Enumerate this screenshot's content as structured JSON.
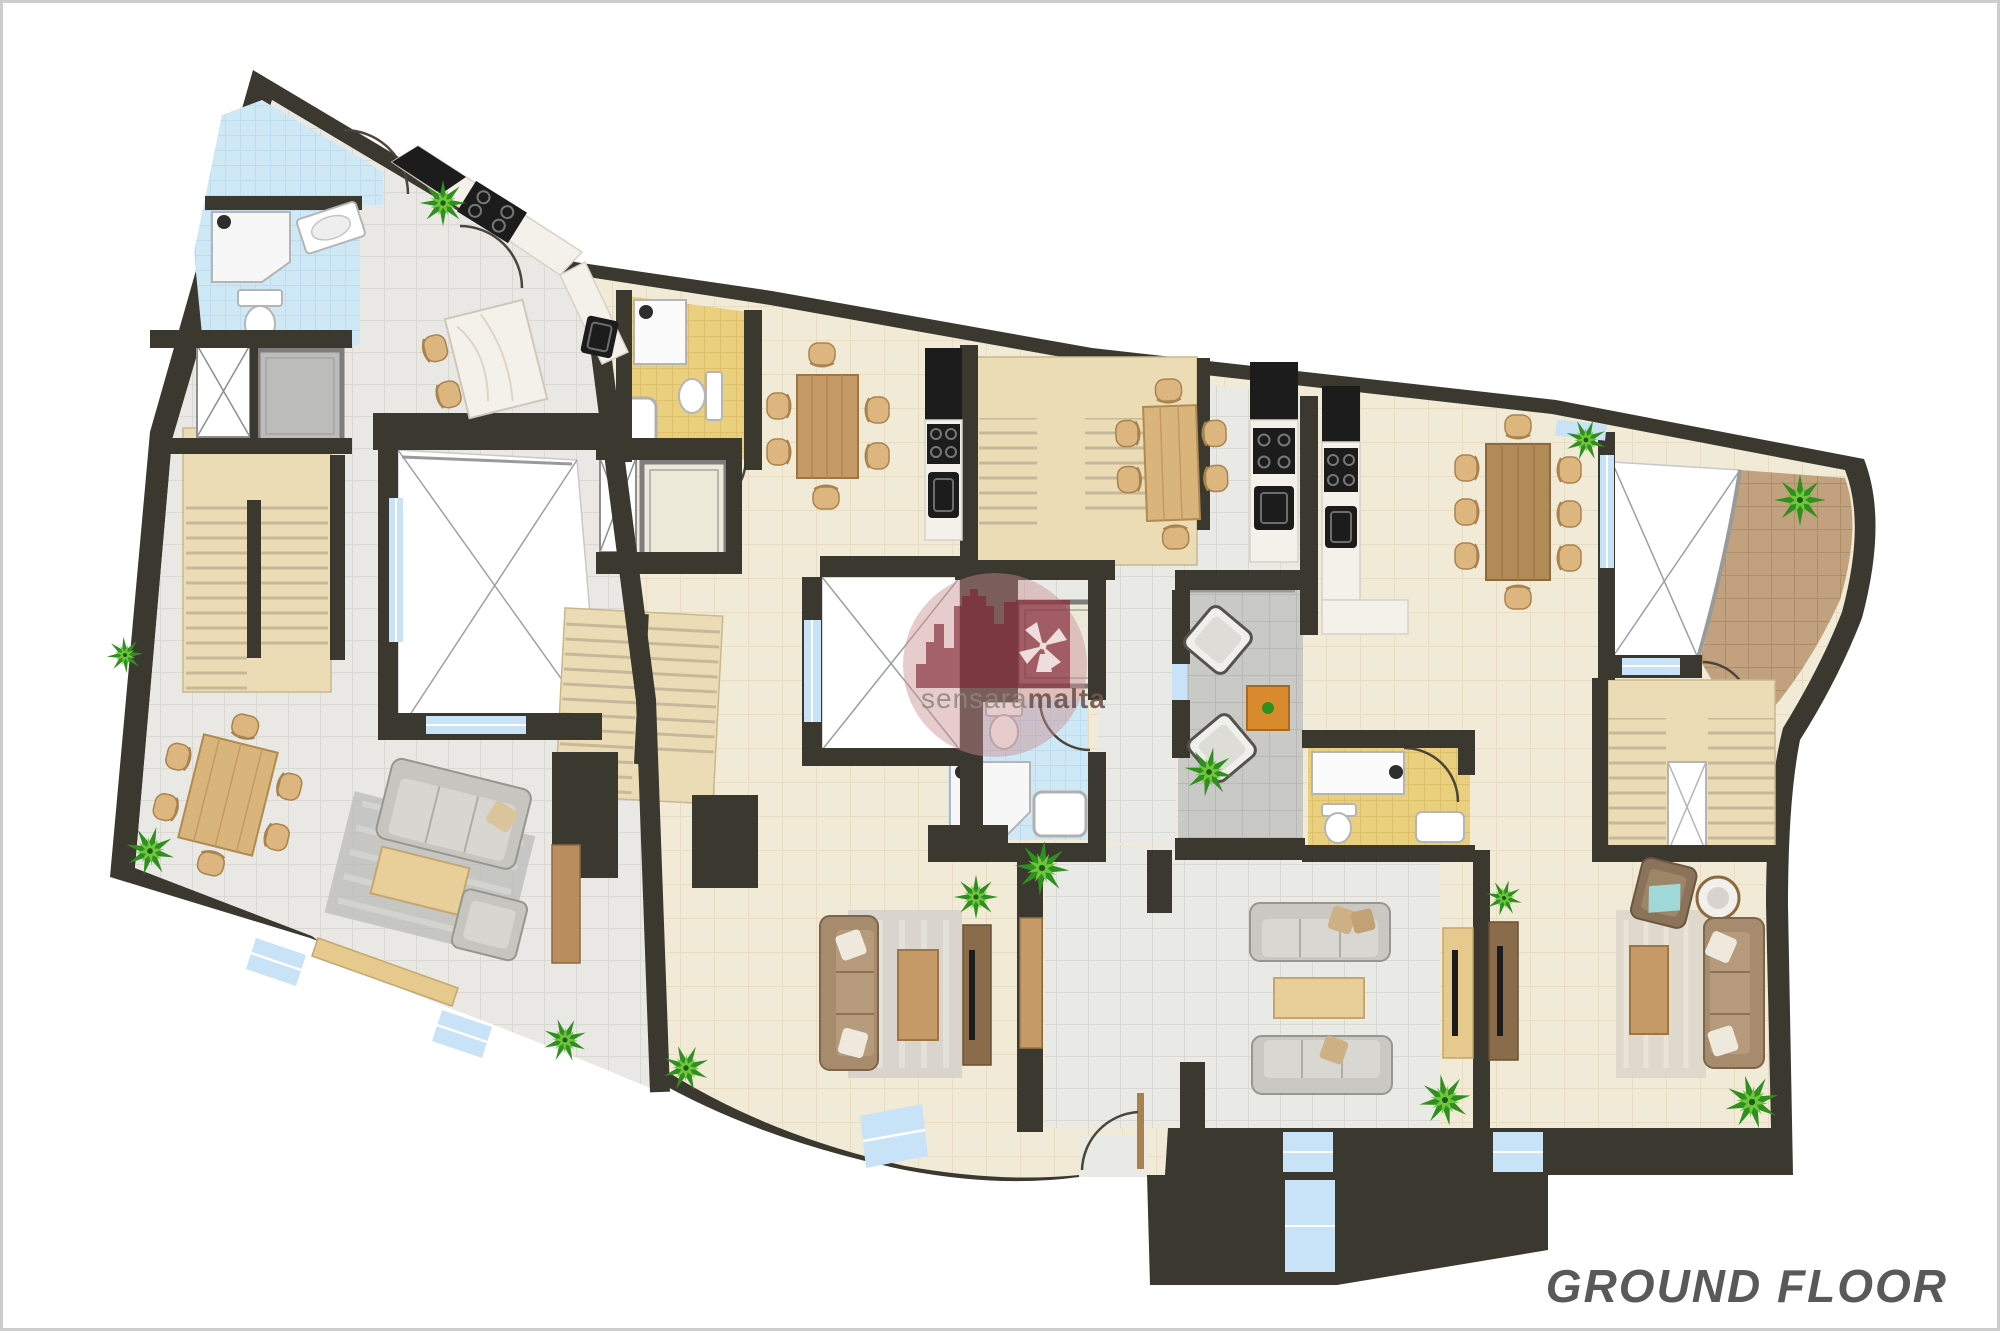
{
  "page": {
    "background": "#ffffff",
    "border_color": "#cdcdcd"
  },
  "plan": {
    "title": "GROUND FLOOR",
    "title_color": "#595959",
    "watermark": {
      "text_light": "sensara",
      "text_bold": "malta",
      "brand_red": "#7e2230",
      "circle_pink": "#c98f92"
    },
    "palette": {
      "wall": "#3b382f",
      "floor_gray": "#e9e8e4",
      "floor_cream": "#f1ead7",
      "bath_blue": "#cfe8f5",
      "bath_yellow": "#ead07e",
      "stair_beige": "#ecdcb6",
      "window_blue": "#c8e3f8",
      "lift_gray": "#bcbcba",
      "lift_beige": "#ede9d9",
      "terrace_tile": "#c2a27e",
      "nook_gray": "#c9c9c6",
      "plant_green": "#4aa32c",
      "wood": "#cfa468",
      "sofa_gray": "#c9c8c3",
      "sofa_brown": "#a68b6d",
      "marble": "#f4f1ea",
      "appliance_black": "#1c1c1c",
      "courtyard_white": "#ffffff"
    },
    "apartments": [
      {
        "id": "apartment-1",
        "floor_finish": "light-gray-tile",
        "rooms": [
          "blue-bathroom",
          "shower-room",
          "lift",
          "light-well",
          "staircase",
          "kitchen-with-island",
          "dining-area",
          "living-area"
        ]
      },
      {
        "id": "apartment-2",
        "floor_finish": "cream-tile",
        "rooms": [
          "yellow-bathroom",
          "lift",
          "light-well",
          "staircase",
          "dining-area",
          "kitchen",
          "living-area",
          "blue-shower-bathroom"
        ]
      },
      {
        "id": "apartment-3",
        "floor_finish": "light-gray-tile",
        "rooms": [
          "staircase",
          "dining-area",
          "kitchen",
          "sitting-nook",
          "lift",
          "living-area"
        ]
      },
      {
        "id": "apartment-4",
        "floor_finish": "cream-tile",
        "rooms": [
          "kitchen",
          "dining-area",
          "yellow-bathroom",
          "courtyard",
          "terrace",
          "staircase",
          "living-area"
        ]
      }
    ],
    "shared_elements": [
      "courtyard-a",
      "courtyard-b",
      "entrance",
      "windows",
      "plants"
    ]
  }
}
